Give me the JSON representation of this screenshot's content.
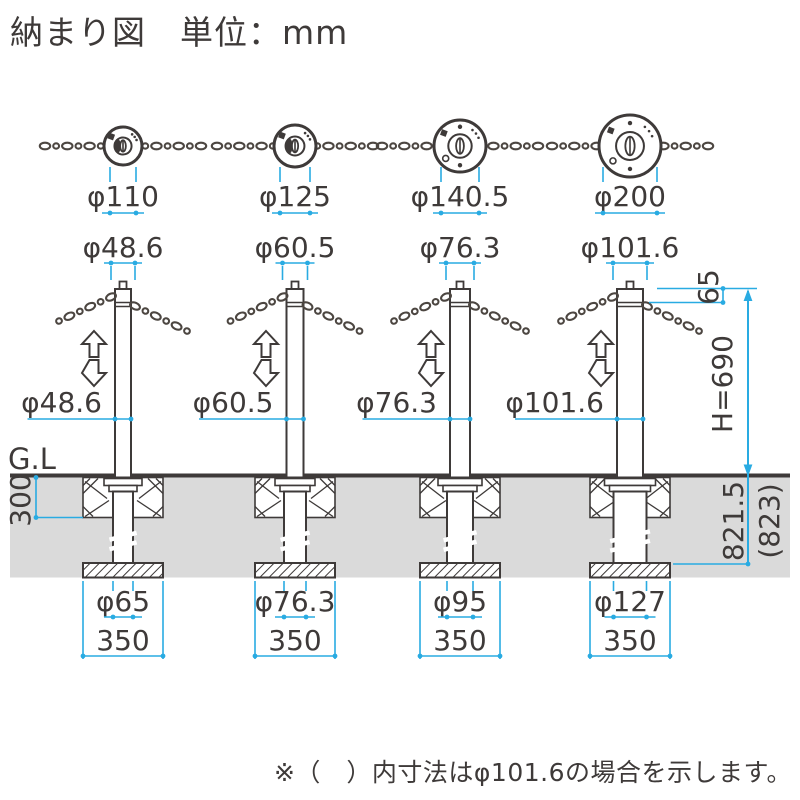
{
  "title": "納まり図　単位：mm",
  "note": "※（　）内寸法はφ101.6の場合を示します。",
  "colors": {
    "accent_blue": "#29ABE2",
    "line_dark": "#3E3A39",
    "ground_gray": "#DADADA",
    "chain": "#4C4641"
  },
  "left": {
    "ground_level": "G.L",
    "embed_depth": "300"
  },
  "right": {
    "cap_offset": "65",
    "height": "H=690",
    "total_length": "821.5",
    "total_length_paren": "(823)"
  },
  "columns": [
    {
      "top_dia": "φ110",
      "pipe_dia": "φ48.6",
      "pipe_dia_mid": "φ48.6",
      "anchor_dia": "φ65",
      "base_width": "350"
    },
    {
      "top_dia": "φ125",
      "pipe_dia": "φ60.5",
      "pipe_dia_mid": "φ60.5",
      "anchor_dia": "φ76.3",
      "base_width": "350"
    },
    {
      "top_dia": "φ140.5",
      "pipe_dia": "φ76.3",
      "pipe_dia_mid": "φ76.3",
      "anchor_dia": "φ95",
      "base_width": "350"
    },
    {
      "top_dia": "φ200",
      "pipe_dia": "φ101.6",
      "pipe_dia_mid": "φ101.6",
      "anchor_dia": "φ127",
      "base_width": "350"
    }
  ]
}
